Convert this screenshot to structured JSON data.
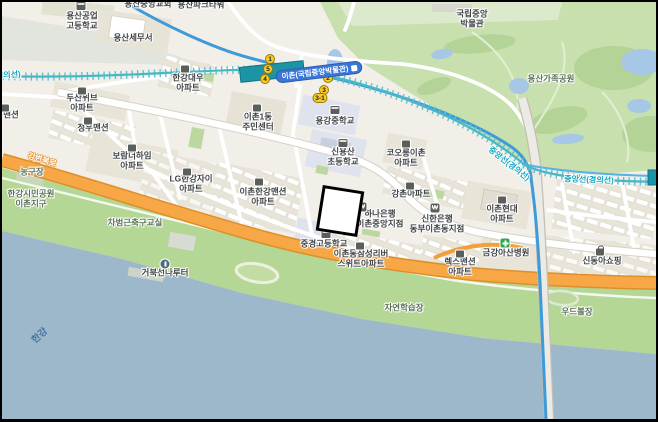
{
  "map": {
    "region_description": "Ichon-dong, Yongsan-gu, Seoul web map",
    "palette": {
      "land": "#f2efe9",
      "park_green": "#c7e0ae",
      "riverside_green": "#b5d795",
      "river_blue": "#9db7cb",
      "expressway_orange": "#f7a746",
      "rail_teal": "#49b7c6",
      "metro_blue": "#3e9bd8",
      "station_fill": "#1d93a6",
      "station_label_bg": "#3b76d6",
      "exit_yellow": "#f9cb26",
      "hospital_green": "#2fa84f",
      "school_block": "#dfe3ee"
    },
    "station": {
      "name": "이촌(국립중앙박물관)"
    },
    "rail_line_name": "중앙선(경의선)",
    "expressway_name": "강변북로",
    "river_name": "한강",
    "exits": [
      {
        "name": "exit-1",
        "label": "1",
        "x": 268,
        "y": 57
      },
      {
        "name": "exit-5",
        "label": "5",
        "x": 266,
        "y": 67
      },
      {
        "name": "exit-4",
        "label": "4",
        "x": 263,
        "y": 77
      },
      {
        "name": "exit-2",
        "label": "2",
        "x": 326,
        "y": 76
      },
      {
        "name": "exit-3",
        "label": "3",
        "x": 322,
        "y": 88
      },
      {
        "name": "exit-3-1",
        "label": "3-1",
        "x": 318,
        "y": 96,
        "wide": true
      }
    ],
    "labels": [
      {
        "name": "label-yongsan-tech-high-school",
        "text": "용산공업\n고등학교",
        "x": 80,
        "y": 19
      },
      {
        "name": "label-yongsan-tax-office",
        "text": "용산세무서",
        "x": 131,
        "y": 36
      },
      {
        "name": "label-yongsan-park-tower",
        "text": "용산파크타워",
        "x": 199,
        "y": 3
      },
      {
        "name": "label-yongsan-church",
        "text": "용산중앙교회",
        "x": 146,
        "y": 2
      },
      {
        "name": "label-hangang-daewoo-apt",
        "text": "한강대우\n아파트",
        "x": 186,
        "y": 81
      },
      {
        "name": "label-doosan-weve-apt",
        "text": "두산위브\n아파트",
        "x": 80,
        "y": 101
      },
      {
        "name": "label-jungwoo-mansion",
        "text": "정우맨션",
        "x": 91,
        "y": 126
      },
      {
        "name": "label-mansion-clipped",
        "text": "맨션",
        "x": 9,
        "y": 113
      },
      {
        "name": "label-boram-theheim-apt",
        "text": "보람더하임\n아파트",
        "x": 130,
        "y": 159
      },
      {
        "name": "label-lg-hangang-xi-apt",
        "text": "LG한강자이\n아파트",
        "x": 189,
        "y": 182
      },
      {
        "name": "label-ichon-hangang-mansion-apt",
        "text": "이촌한강맨션\n아파트",
        "x": 261,
        "y": 195
      },
      {
        "name": "label-ichon1dong-community-center",
        "text": "이촌1동\n주민센터",
        "x": 256,
        "y": 120
      },
      {
        "name": "label-yonggang-middle-school",
        "text": "용강중학교",
        "x": 333,
        "y": 119
      },
      {
        "name": "label-sinyongsan-elementary",
        "text": "신용산\n초등학교",
        "x": 341,
        "y": 155
      },
      {
        "name": "label-kolon-ichon-apt",
        "text": "코오롱이촌\n아파트",
        "x": 404,
        "y": 156
      },
      {
        "name": "label-gangchon-apt",
        "text": "강촌아파트",
        "x": 409,
        "y": 192
      },
      {
        "name": "label-ichon-hyundai-apt",
        "text": "이촌현대\n아파트",
        "x": 500,
        "y": 212
      },
      {
        "name": "label-shinhan-bank-dongbu-ichon",
        "text": "신한은행\n동부이촌동지점",
        "x": 435,
        "y": 222
      },
      {
        "name": "label-hana-bank-ichon-jungang",
        "text": "하나은행\n이촌중앙지점",
        "x": 378,
        "y": 217
      },
      {
        "name": "label-junggyeong-high-school",
        "text": "중경고등학교",
        "x": 322,
        "y": 242
      },
      {
        "name": "label-samsung-riversuite-apt",
        "text": "이촌동삼성리버\n스위트아파트",
        "x": 359,
        "y": 257
      },
      {
        "name": "label-kumkang-asan-hospital",
        "text": "금강아산병원",
        "x": 504,
        "y": 251
      },
      {
        "name": "label-rex-mansion-apt",
        "text": "렉스맨션\n아파트",
        "x": 458,
        "y": 265
      },
      {
        "name": "label-sindonga-shopping",
        "text": "신동아쇼핑",
        "x": 600,
        "y": 259
      },
      {
        "name": "label-national-museum",
        "text": "국립중앙\n박물관",
        "x": 470,
        "y": 17
      },
      {
        "name": "label-yongsan-family-park",
        "text": "용산가족공원",
        "x": 549,
        "y": 77,
        "cls": "park"
      },
      {
        "name": "label-cha-bumkun-soccer-school",
        "text": "차범근축구교실",
        "x": 133,
        "y": 221,
        "cls": "park"
      },
      {
        "name": "label-basketball-court",
        "text": "농구장",
        "x": 30,
        "y": 170,
        "cls": "park"
      },
      {
        "name": "label-hangang-citizens-park-ichon",
        "text": "한강시민공원\n이촌지구",
        "x": 29,
        "y": 197,
        "cls": "park"
      },
      {
        "name": "label-geobukseon-ferry",
        "text": "거북선나루터",
        "x": 163,
        "y": 271
      },
      {
        "name": "label-nature-learning-site",
        "text": "자연학습장",
        "x": 402,
        "y": 306,
        "cls": "park"
      },
      {
        "name": "label-woodball-court",
        "text": "우드볼장",
        "x": 575,
        "y": 310,
        "cls": "park"
      },
      {
        "name": "label-hangang-river",
        "text": "한강",
        "x": 38,
        "y": 334,
        "cls": "water",
        "rot": -42
      },
      {
        "name": "label-gangbyeonbuk-ro",
        "text": "강변북로",
        "x": 40,
        "y": 158,
        "cls": "hwy",
        "rot": 17
      },
      {
        "name": "label-rail-line-diagonal",
        "text": "중앙선(경의선)",
        "x": 507,
        "y": 162,
        "cls": "rail",
        "rot": 38
      },
      {
        "name": "label-rail-line-east",
        "text": "중앙선(경의선)",
        "x": 587,
        "y": 178,
        "cls": "rail",
        "rot": 2
      },
      {
        "name": "label-rail-line-west",
        "text": "중앙선(경의선)",
        "x": -6,
        "y": 74,
        "cls": "rail",
        "rot": -4
      }
    ],
    "icons": [
      {
        "name": "school-icon",
        "cls": "icon-school",
        "x": 79,
        "y": 4
      },
      {
        "name": "building-icon",
        "cls": "icon-building",
        "x": 183,
        "y": 67
      },
      {
        "name": "building-icon",
        "cls": "icon-building",
        "x": 80,
        "y": 89
      },
      {
        "name": "building-icon",
        "cls": "icon-building",
        "x": 86,
        "y": 119
      },
      {
        "name": "building-icon",
        "cls": "icon-building",
        "x": 3,
        "y": 106
      },
      {
        "name": "building-icon",
        "cls": "icon-building",
        "x": 130,
        "y": 146
      },
      {
        "name": "building-icon",
        "cls": "icon-building",
        "x": 185,
        "y": 170
      },
      {
        "name": "building-icon",
        "cls": "icon-building",
        "x": 257,
        "y": 180
      },
      {
        "name": "building-icon",
        "cls": "icon-building",
        "x": 255,
        "y": 106
      },
      {
        "name": "school-icon",
        "cls": "icon-school",
        "x": 333,
        "y": 108
      },
      {
        "name": "school-icon",
        "cls": "icon-school",
        "x": 341,
        "y": 141
      },
      {
        "name": "building-icon",
        "cls": "icon-building",
        "x": 404,
        "y": 142
      },
      {
        "name": "building-icon",
        "cls": "icon-building",
        "x": 408,
        "y": 184
      },
      {
        "name": "building-icon",
        "cls": "icon-building",
        "x": 500,
        "y": 198
      },
      {
        "name": "bank-icon",
        "cls": "icon-bank",
        "x": 360,
        "y": 205,
        "glyph": "₩"
      },
      {
        "name": "bank-icon",
        "cls": "icon-bank",
        "x": 433,
        "y": 206,
        "glyph": "₩"
      },
      {
        "name": "school-icon",
        "cls": "icon-school",
        "x": 324,
        "y": 232
      },
      {
        "name": "building-icon",
        "cls": "icon-building",
        "x": 358,
        "y": 244
      },
      {
        "name": "hospital-icon",
        "cls": "icon-hospital",
        "x": 503,
        "y": 241
      },
      {
        "name": "shopping-icon",
        "cls": "icon-shop",
        "x": 598,
        "y": 250
      },
      {
        "name": "ferry-icon",
        "cls": "icon-port",
        "x": 163,
        "y": 262
      },
      {
        "name": "building-icon",
        "cls": "icon-building",
        "x": 458,
        "y": 252
      }
    ]
  }
}
